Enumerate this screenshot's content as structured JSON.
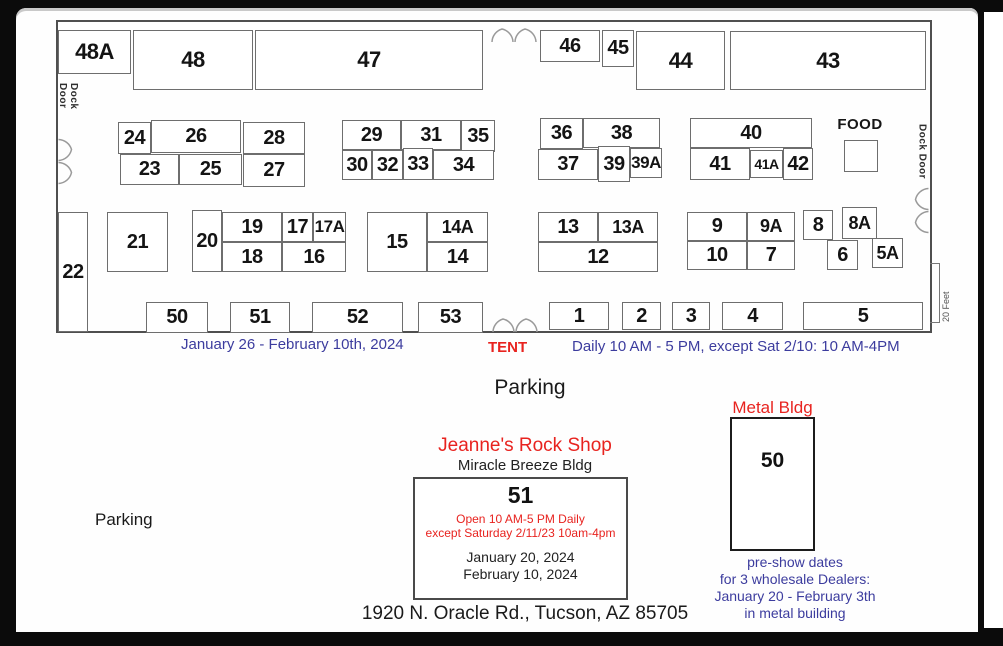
{
  "page": {
    "parking_center": "Parking",
    "parking_left": "Parking",
    "address": "1920 N. Oracle Rd., Tucson, AZ 85705"
  },
  "hall": {
    "dock_door_left": "Dock Door",
    "dock_door_right": "Dock Door",
    "food_label": "FOOD",
    "scale_label": "20 Feet",
    "booths": [
      {
        "label": "48A",
        "x": 58,
        "y": 30,
        "w": 73,
        "h": 44,
        "fs": 22
      },
      {
        "label": "48",
        "x": 133,
        "y": 30,
        "w": 120,
        "h": 60,
        "fs": 22
      },
      {
        "label": "47",
        "x": 255,
        "y": 30,
        "w": 228,
        "h": 60,
        "fs": 22
      },
      {
        "label": "46",
        "x": 540,
        "y": 30,
        "w": 60,
        "h": 32
      },
      {
        "label": "45",
        "x": 602,
        "y": 30,
        "w": 32,
        "h": 37
      },
      {
        "label": "44",
        "x": 636,
        "y": 31,
        "w": 89,
        "h": 59,
        "fs": 22
      },
      {
        "label": "43",
        "x": 730,
        "y": 31,
        "w": 196,
        "h": 59,
        "fs": 22
      },
      {
        "label": "24",
        "x": 118,
        "y": 122,
        "w": 33,
        "h": 32
      },
      {
        "label": "26",
        "x": 151,
        "y": 120,
        "w": 90,
        "h": 33
      },
      {
        "label": "28",
        "x": 243,
        "y": 122,
        "w": 62,
        "h": 32
      },
      {
        "label": "23",
        "x": 120,
        "y": 154,
        "w": 59,
        "h": 31
      },
      {
        "label": "25",
        "x": 179,
        "y": 154,
        "w": 63,
        "h": 31
      },
      {
        "label": "27",
        "x": 243,
        "y": 154,
        "w": 62,
        "h": 33
      },
      {
        "label": "29",
        "x": 342,
        "y": 120,
        "w": 59,
        "h": 30
      },
      {
        "label": "31",
        "x": 401,
        "y": 120,
        "w": 60,
        "h": 30
      },
      {
        "label": "35",
        "x": 461,
        "y": 120,
        "w": 34,
        "h": 32
      },
      {
        "label": "30",
        "x": 342,
        "y": 150,
        "w": 30,
        "h": 30
      },
      {
        "label": "32",
        "x": 372,
        "y": 150,
        "w": 31,
        "h": 30
      },
      {
        "label": "33",
        "x": 403,
        "y": 148,
        "w": 30,
        "h": 32
      },
      {
        "label": "34",
        "x": 433,
        "y": 150,
        "w": 61,
        "h": 30
      },
      {
        "label": "36",
        "x": 540,
        "y": 118,
        "w": 43,
        "h": 31
      },
      {
        "label": "38",
        "x": 583,
        "y": 118,
        "w": 77,
        "h": 30
      },
      {
        "label": "37",
        "x": 538,
        "y": 149,
        "w": 60,
        "h": 31
      },
      {
        "label": "39",
        "x": 598,
        "y": 146,
        "w": 32,
        "h": 36
      },
      {
        "label": "39A",
        "x": 630,
        "y": 148,
        "w": 32,
        "h": 30,
        "fs": 17
      },
      {
        "label": "40",
        "x": 690,
        "y": 118,
        "w": 122,
        "h": 30
      },
      {
        "label": "41",
        "x": 690,
        "y": 148,
        "w": 60,
        "h": 32
      },
      {
        "label": "41A",
        "x": 750,
        "y": 150,
        "w": 33,
        "h": 28,
        "fs": 14
      },
      {
        "label": "42",
        "x": 783,
        "y": 148,
        "w": 30,
        "h": 32
      },
      {
        "label": "",
        "x": 844,
        "y": 140,
        "w": 34,
        "h": 32
      },
      {
        "label": "22",
        "x": 58,
        "y": 212,
        "w": 30,
        "h": 120
      },
      {
        "label": "21",
        "x": 107,
        "y": 212,
        "w": 61,
        "h": 60
      },
      {
        "label": "20",
        "x": 192,
        "y": 210,
        "w": 30,
        "h": 62
      },
      {
        "label": "19",
        "x": 222,
        "y": 212,
        "w": 60,
        "h": 30
      },
      {
        "label": "17",
        "x": 282,
        "y": 212,
        "w": 31,
        "h": 30
      },
      {
        "label": "17A",
        "x": 313,
        "y": 212,
        "w": 33,
        "h": 30,
        "fs": 17
      },
      {
        "label": "18",
        "x": 222,
        "y": 242,
        "w": 60,
        "h": 30
      },
      {
        "label": "16",
        "x": 282,
        "y": 242,
        "w": 64,
        "h": 30
      },
      {
        "label": "15",
        "x": 367,
        "y": 212,
        "w": 60,
        "h": 60
      },
      {
        "label": "14A",
        "x": 427,
        "y": 212,
        "w": 61,
        "h": 30,
        "fs": 18
      },
      {
        "label": "14",
        "x": 427,
        "y": 242,
        "w": 61,
        "h": 30
      },
      {
        "label": "13",
        "x": 538,
        "y": 212,
        "w": 60,
        "h": 30
      },
      {
        "label": "13A",
        "x": 598,
        "y": 212,
        "w": 60,
        "h": 30,
        "fs": 18
      },
      {
        "label": "12",
        "x": 538,
        "y": 242,
        "w": 120,
        "h": 30
      },
      {
        "label": "9",
        "x": 687,
        "y": 212,
        "w": 60,
        "h": 29
      },
      {
        "label": "9A",
        "x": 747,
        "y": 212,
        "w": 48,
        "h": 29,
        "fs": 18
      },
      {
        "label": "10",
        "x": 687,
        "y": 241,
        "w": 60,
        "h": 29
      },
      {
        "label": "7",
        "x": 747,
        "y": 241,
        "w": 48,
        "h": 29
      },
      {
        "label": "8",
        "x": 803,
        "y": 210,
        "w": 30,
        "h": 30
      },
      {
        "label": "8A",
        "x": 842,
        "y": 207,
        "w": 35,
        "h": 32,
        "fs": 18
      },
      {
        "label": "6",
        "x": 827,
        "y": 240,
        "w": 31,
        "h": 30
      },
      {
        "label": "5A",
        "x": 872,
        "y": 238,
        "w": 31,
        "h": 30,
        "fs": 18
      },
      {
        "label": "50",
        "x": 146,
        "y": 302,
        "w": 62,
        "h": 31
      },
      {
        "label": "51",
        "x": 230,
        "y": 302,
        "w": 60,
        "h": 31
      },
      {
        "label": "52",
        "x": 312,
        "y": 302,
        "w": 91,
        "h": 31
      },
      {
        "label": "53",
        "x": 418,
        "y": 302,
        "w": 65,
        "h": 31
      },
      {
        "label": "1",
        "x": 549,
        "y": 302,
        "w": 60,
        "h": 28
      },
      {
        "label": "2",
        "x": 622,
        "y": 302,
        "w": 39,
        "h": 28
      },
      {
        "label": "3",
        "x": 672,
        "y": 302,
        "w": 38,
        "h": 28
      },
      {
        "label": "4",
        "x": 722,
        "y": 302,
        "w": 61,
        "h": 28
      },
      {
        "label": "5",
        "x": 803,
        "y": 302,
        "w": 120,
        "h": 28
      }
    ]
  },
  "notes": {
    "show_dates": "January 26 - February 10th, 2024",
    "tent": "TENT",
    "hours": "Daily 10 AM - 5 PM, except Sat 2/10: 10 AM-4PM"
  },
  "miracle": {
    "shop_name": "Jeanne's Rock Shop",
    "bldg_name": "Miracle Breeze Bldg",
    "booth": "51",
    "hours_line1": "Open 10 AM-5 PM Daily",
    "hours_line2": "except Saturday 2/11/23 10am-4pm",
    "date1": "January 20, 2024",
    "date2": "February 10, 2024"
  },
  "metal": {
    "label": "Metal Bldg",
    "booth": "50",
    "preshow": [
      "pre-show dates",
      "for 3 wholesale Dealers:",
      "January 20 - February 3th",
      "in metal building"
    ]
  },
  "colors": {
    "note_blue": "#3c3c9e",
    "accent_red": "#e8231f",
    "booth_border": "#6e6e6e"
  }
}
